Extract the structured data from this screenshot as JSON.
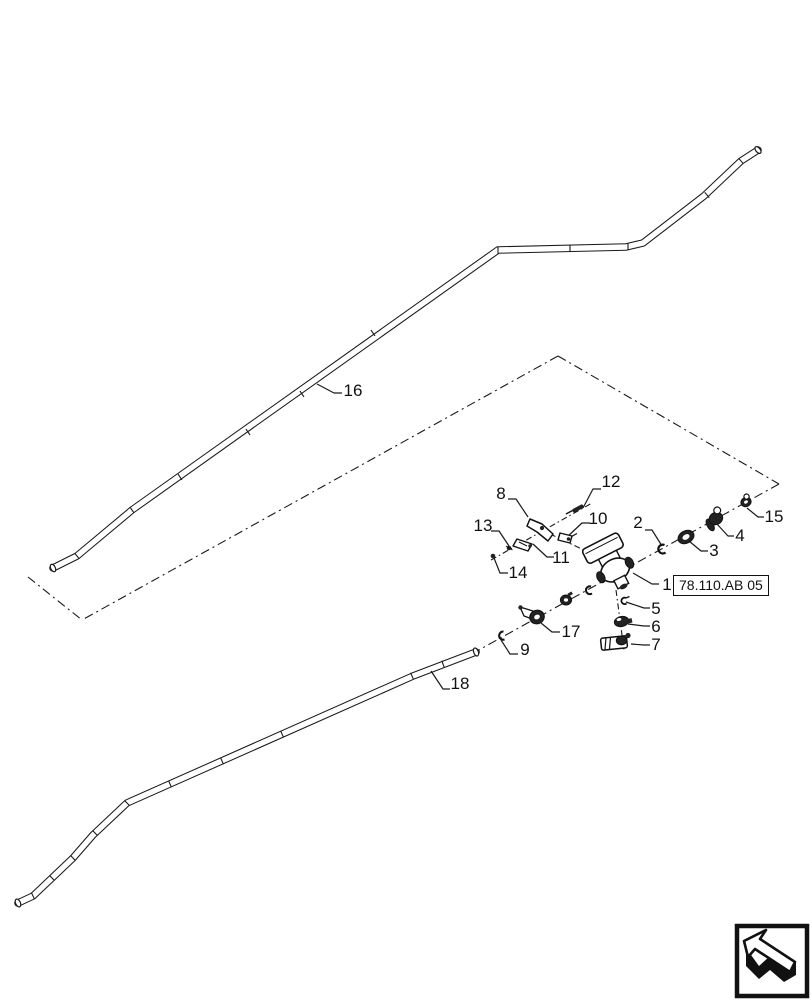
{
  "figure": {
    "type": "exploded-parts-diagram",
    "background": "#ffffff",
    "line_color": "#1a1a1a",
    "reference_box": {
      "label": "78.110.AB 05"
    },
    "callouts": {
      "c1": "1",
      "c2": "2",
      "c3": "3",
      "c4": "4",
      "c5": "5",
      "c6": "6",
      "c7": "7",
      "c8": "8",
      "c9": "9",
      "c10": "10",
      "c11": "11",
      "c12": "12",
      "c13": "13",
      "c14": "14",
      "c15": "15",
      "c16": "16",
      "c17": "17",
      "c18": "18"
    },
    "icons": {
      "nav": "back-arrow-icon"
    }
  }
}
